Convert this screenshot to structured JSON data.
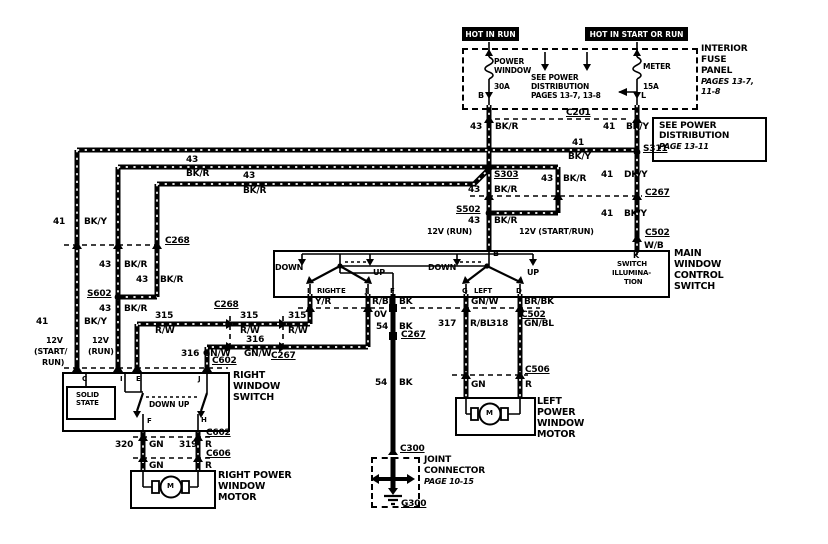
{
  "colors": {
    "ink": "#000000",
    "paper": "#ffffff"
  },
  "fuse_panel": {
    "hot_in_run": "HOT IN RUN",
    "hot_in_start_or_run": "HOT IN START OR RUN",
    "fuse_power_window_l1": "POWER",
    "fuse_power_window_l2": "WINDOW",
    "fuse_power_window_rating": "30A",
    "fuse_meter": "METER",
    "fuse_meter_rating": "15A",
    "see_dist_l1": "SEE POWER",
    "see_dist_l2": "DISTRIBUTION",
    "see_dist_l3": "PAGES 13-7, 13-8",
    "pin_b": "B",
    "pin_l": "L",
    "panel_l1": "INTERIOR",
    "panel_l2": "FUSE",
    "panel_l3": "PANEL",
    "panel_pages_l1": "PAGES 13-7,",
    "panel_pages_l2": "11-8"
  },
  "power_dist_box": {
    "l1": "SEE POWER",
    "l2": "DISTRIBUTION",
    "page": "PAGE 13-11"
  },
  "connectors": {
    "c201": "C201",
    "s311": "S311",
    "c267": "C267",
    "c502": "C502",
    "s303": "S303",
    "s502": "S502",
    "c268": "C268",
    "s602": "S602",
    "c602": "C602",
    "c606": "C606",
    "c506": "C506",
    "c300": "C300",
    "g300": "G300"
  },
  "wires": {
    "n41": "41",
    "n43": "43",
    "n54": "54",
    "n315": "315",
    "n316": "316",
    "n317": "317",
    "n318": "318",
    "n319": "319",
    "n320": "320",
    "bk_r": "BK/R",
    "bk_y": "BK/Y",
    "dk_y": "DK/Y",
    "w_b": "W/B",
    "y_r": "Y/R",
    "r_bk": "R/BK",
    "bk": "BK",
    "gn_w": "GN/W",
    "br_bk": "BR/BK",
    "r_w": "R/W",
    "r_bl": "R/BL",
    "gn_bl": "GN/BL",
    "gn": "GN",
    "r": "R"
  },
  "voltages": {
    "v12_run": "12V (RUN)",
    "v12_start_run": "12V (START/RUN)",
    "v12": "12V",
    "start_l": "(START/",
    "run_l": "RUN)",
    "run_paren": "(RUN)",
    "v0": "0V"
  },
  "main_switch": {
    "t1": "MAIN",
    "t2": "WINDOW",
    "t3": "CONTROL",
    "t4": "SWITCH",
    "pin_b": "B",
    "pin_k": "K",
    "illum1": "SWITCH",
    "illum2": "ILLUMINA-",
    "illum3": "TION",
    "down": "DOWN",
    "up": "UP",
    "pin_i": "I",
    "right": "RIGHT",
    "pin_e": "E",
    "pin_j": "J",
    "pin_f": "F",
    "pin_g": "G",
    "left": "LEFT",
    "pin_d": "D"
  },
  "right_switch": {
    "t1": "RIGHT",
    "t2": "WINDOW",
    "t3": "SWITCH",
    "solid1": "SOLID",
    "solid2": "STATE",
    "down": "DOWN",
    "up": "UP",
    "pin_c": "C",
    "pin_i": "I",
    "pin_e": "E",
    "pin_j": "J",
    "pin_f": "F",
    "pin_h": "H"
  },
  "motors": {
    "right_l1": "RIGHT POWER",
    "right_l2": "WINDOW",
    "right_l3": "MOTOR",
    "left_l1": "LEFT",
    "left_l2": "POWER",
    "left_l3": "WINDOW",
    "left_l4": "MOTOR",
    "m": "M"
  },
  "joint_connector": {
    "l1": "JOINT",
    "l2": "CONNECTOR",
    "page": "PAGE 10-15"
  }
}
